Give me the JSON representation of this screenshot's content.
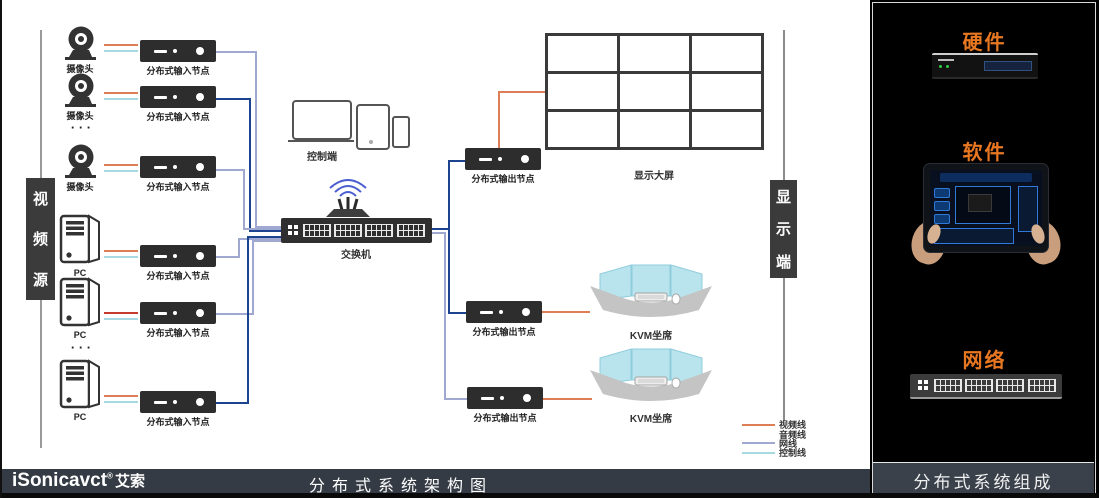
{
  "labels": {
    "camera": "摄像头",
    "pc": "PC",
    "input_node": "分布式输入节点",
    "output_node": "分布式输出节点",
    "control_end": "控制端",
    "switch": "交换机",
    "display_wall": "显示大屏",
    "kvm": "KVM坐席",
    "ellipsis": "· · ·"
  },
  "video_source": {
    "c0": "视",
    "c1": "频",
    "c2": "源"
  },
  "display_end": {
    "c0": "显",
    "c1": "示",
    "c2": "端"
  },
  "legend": {
    "rows": [
      {
        "label": "视频线",
        "swatch": "background:#DD7E57"
      },
      {
        "label": "音频线",
        "swatch": "background:transparent"
      },
      {
        "label": "网线",
        "swatch": "background:#9FA8D0"
      },
      {
        "label": "控制线",
        "swatch": "background:#A6D9E2"
      }
    ]
  },
  "colors": {
    "video_line": "#DD7E57",
    "audio_line": "#C63D2F",
    "network_line": "#9FA8D0",
    "control_line": "#A6D9E2",
    "backbone_navy": "#1B438F",
    "accent_orange": "#E87722"
  },
  "footer": {
    "brand": "iSonicavct",
    "registered": "®",
    "brand_cn": "艾索",
    "title": "分布式系统架构图"
  },
  "side_panel": {
    "hardware_title": "硬件",
    "software_title": "软件",
    "network_title": "网络",
    "footer_title": "分布式系统组成"
  }
}
